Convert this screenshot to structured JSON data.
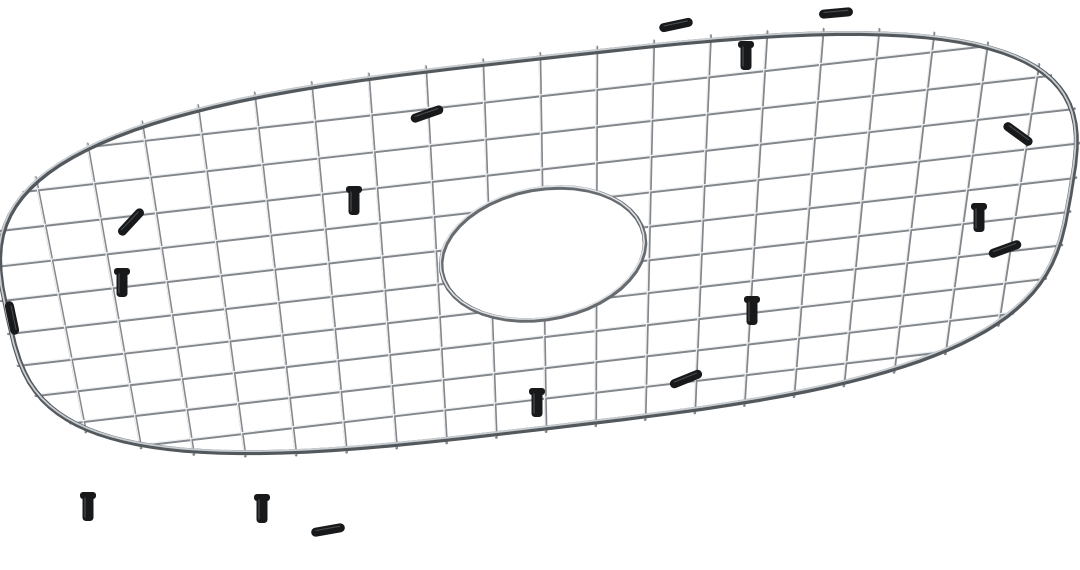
{
  "scene": {
    "width": 1080,
    "height": 570,
    "background": "#ffffff"
  },
  "grid_model": {
    "local": {
      "length": 1000,
      "width": 540,
      "superellipse_n": 3.2,
      "long_wires": 10,
      "cross_wires": 19,
      "overhang_cross": 6,
      "overhang_long": 3,
      "hole": {
        "cu": 500,
        "cv": 270,
        "r": 96
      }
    },
    "projection": {
      "src": [
        [
          500,
          0
        ],
        [
          500,
          540
        ],
        [
          0,
          270
        ],
        [
          1000,
          270
        ]
      ],
      "dst": [
        [
          540,
          58
        ],
        [
          546,
          428
        ],
        [
          8,
          317
        ],
        [
          1070,
          195
        ]
      ]
    },
    "colors": {
      "wire_dark": "#83878b",
      "wire_light": "#edeff1",
      "rim_dark": "#53585d",
      "rim_light": "#c9ced3",
      "ring_dark": "#666b70",
      "ring_light": "#dfe2e5",
      "foot": "#17191b",
      "foot_highlight": "#4a4d50"
    },
    "strokes": {
      "wire_w": 2.7,
      "wire_hi_w": 1.2,
      "rim_w": 5,
      "rim_hi_w": 1.8,
      "ring_w": 4.6,
      "ring_hi_w": 1.6,
      "hi_dx": -0.9,
      "hi_dy": -1.1
    }
  },
  "feet": {
    "sleeve_len": 34,
    "sleeve_w": 9,
    "clip_w": 11,
    "clip_h": 27,
    "sleeves": [
      {
        "x": 427,
        "y": 114,
        "angle": -19
      },
      {
        "x": 676,
        "y": 25,
        "angle": -12
      },
      {
        "x": 836,
        "y": 13,
        "angle": -5
      },
      {
        "x": 1018,
        "y": 134,
        "angle": 36
      },
      {
        "x": 1005,
        "y": 249,
        "angle": -20
      },
      {
        "x": 686,
        "y": 379,
        "angle": -22
      },
      {
        "x": 328,
        "y": 530,
        "angle": -10
      },
      {
        "x": 131,
        "y": 222,
        "angle": -47
      },
      {
        "x": 12,
        "y": 318,
        "angle": 78
      }
    ],
    "clips": [
      {
        "x": 122,
        "y": 272
      },
      {
        "x": 354,
        "y": 190
      },
      {
        "x": 746,
        "y": 45
      },
      {
        "x": 979,
        "y": 207
      },
      {
        "x": 752,
        "y": 300
      },
      {
        "x": 537,
        "y": 392
      },
      {
        "x": 262,
        "y": 498
      },
      {
        "x": 88,
        "y": 496
      }
    ]
  }
}
